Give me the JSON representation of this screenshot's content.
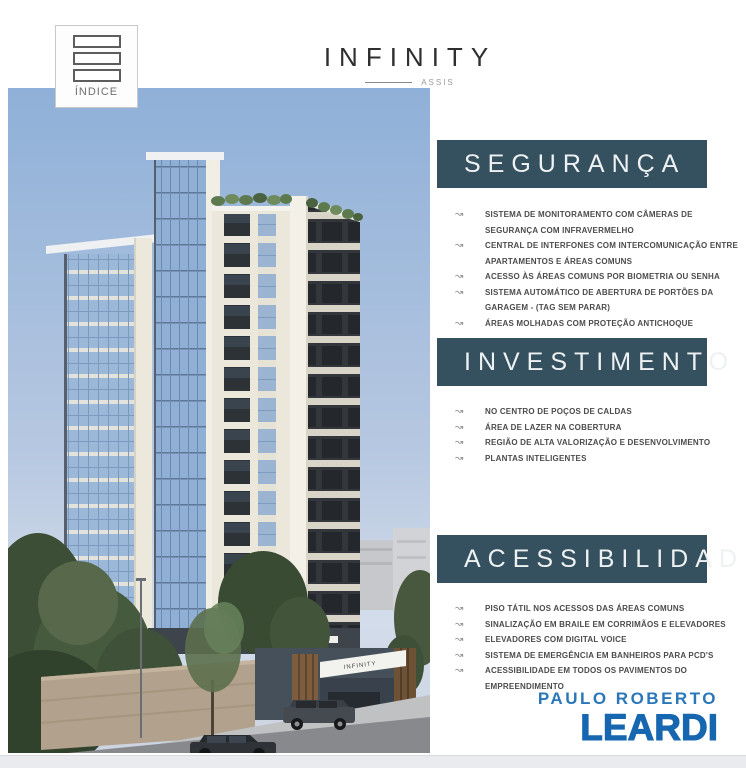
{
  "header": {
    "index_button_label": "ÍNDICE",
    "project_name": "INFINITY",
    "project_location": "ASSIS"
  },
  "building": {
    "sign_text": "INFINITY"
  },
  "sections": [
    {
      "title": "SEGURANÇA",
      "items": [
        "SISTEMA DE MONITORAMENTO COM CÂMERAS DE SEGURANÇA COM INFRAVERMELHO",
        "CENTRAL DE INTERFONES COM INTERCOMUNICAÇÃO ENTRE APARTAMENTOS E ÁREAS COMUNS",
        "ACESSO ÀS ÁREAS COMUNS POR BIOMETRIA OU SENHA",
        "SISTEMA AUTOMÁTICO DE ABERTURA DE PORTÕES DA GARAGEM - (TAG SEM PARAR)",
        "ÁREAS MOLHADAS COM PROTEÇÃO ANTICHOQUE"
      ]
    },
    {
      "title": "INVESTIMENTO",
      "items": [
        "NO CENTRO DE POÇOS DE CALDAS",
        "ÁREA DE LAZER NA COBERTURA",
        "REGIÃO DE ALTA VALORIZAÇÃO E DESENVOLVIMENTO",
        "PLANTAS INTELIGENTES"
      ]
    },
    {
      "title": "ACESSIBILIDADE",
      "items": [
        "PISO TÁTIL NOS ACESSOS DAS ÁREAS COMUNS",
        "SINALIZAÇÃO EM BRAILE EM CORRIMÃOS E ELEVADORES",
        "ELEVADORES COM DIGITAL VOICE",
        "SISTEMA DE EMERGÊNCIA EM BANHEIROS PARA PCD'S",
        "ACESSIBILIDADE EM TODOS OS PAVIMENTOS DO EMPREENDIMENTO"
      ]
    }
  ],
  "footer": {
    "agency_top": "PAULO ROBERTO",
    "agency_name": "LEARDI"
  },
  "icons": {
    "wave_arrow": "↝",
    "index_button": "stacked-rectangles"
  },
  "colors": {
    "section_bar": "#35505f",
    "agency_blue": "#1767b0",
    "agency_blue_light": "#2a77ba",
    "sky": "#8fb0d8"
  }
}
